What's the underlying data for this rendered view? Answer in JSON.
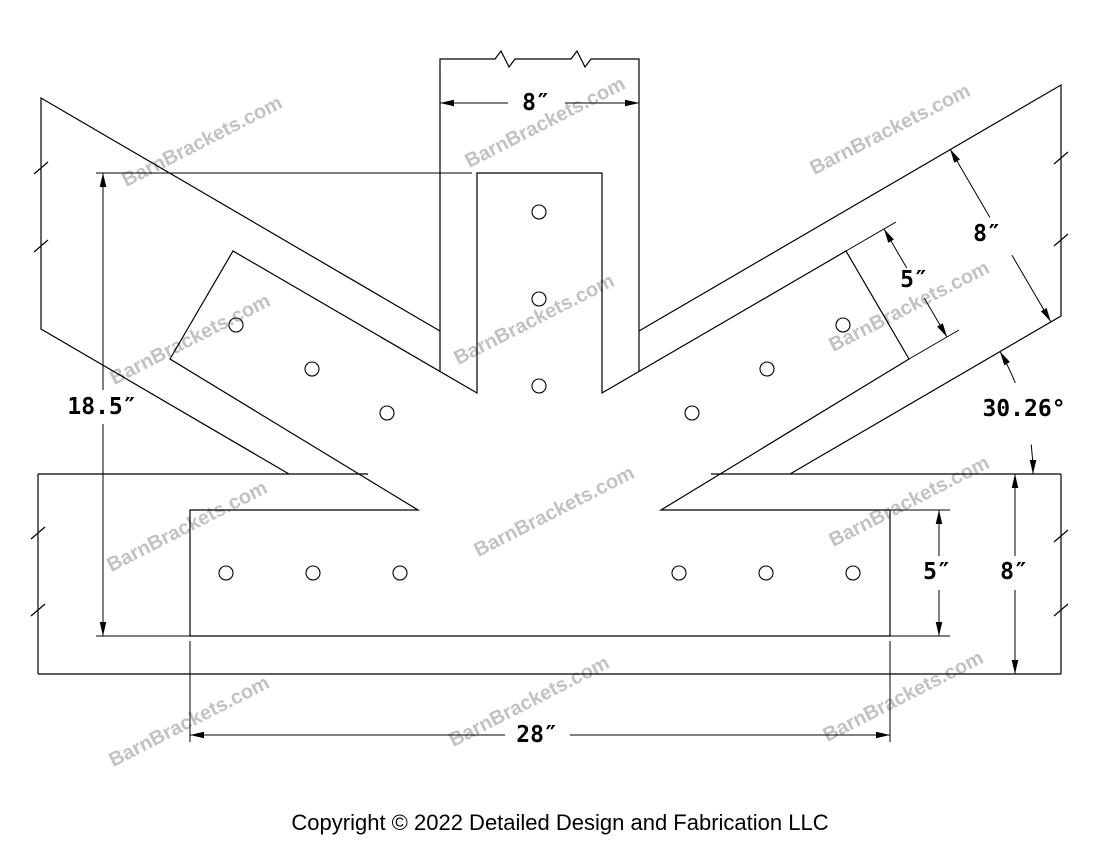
{
  "title_block": {
    "copyright": "Copyright © 2022 Detailed Design and Fabrication LLC"
  },
  "watermark": {
    "text": "BarnBrackets.com"
  },
  "dimensions": {
    "post_width": "8″",
    "overall_height": "18.5″",
    "bottom_plate_length": "28″",
    "diagonal_beam_width": "8″",
    "diagonal_plate_width": "5″",
    "horizontal_beam_depth": "8″",
    "bottom_plate_width": "5″",
    "brace_angle": "30.26°"
  },
  "drawing": {
    "line_color": "#000000",
    "watermark_color": "#b3b3b3",
    "background": "#ffffff",
    "bolt_hole_count": 15
  }
}
